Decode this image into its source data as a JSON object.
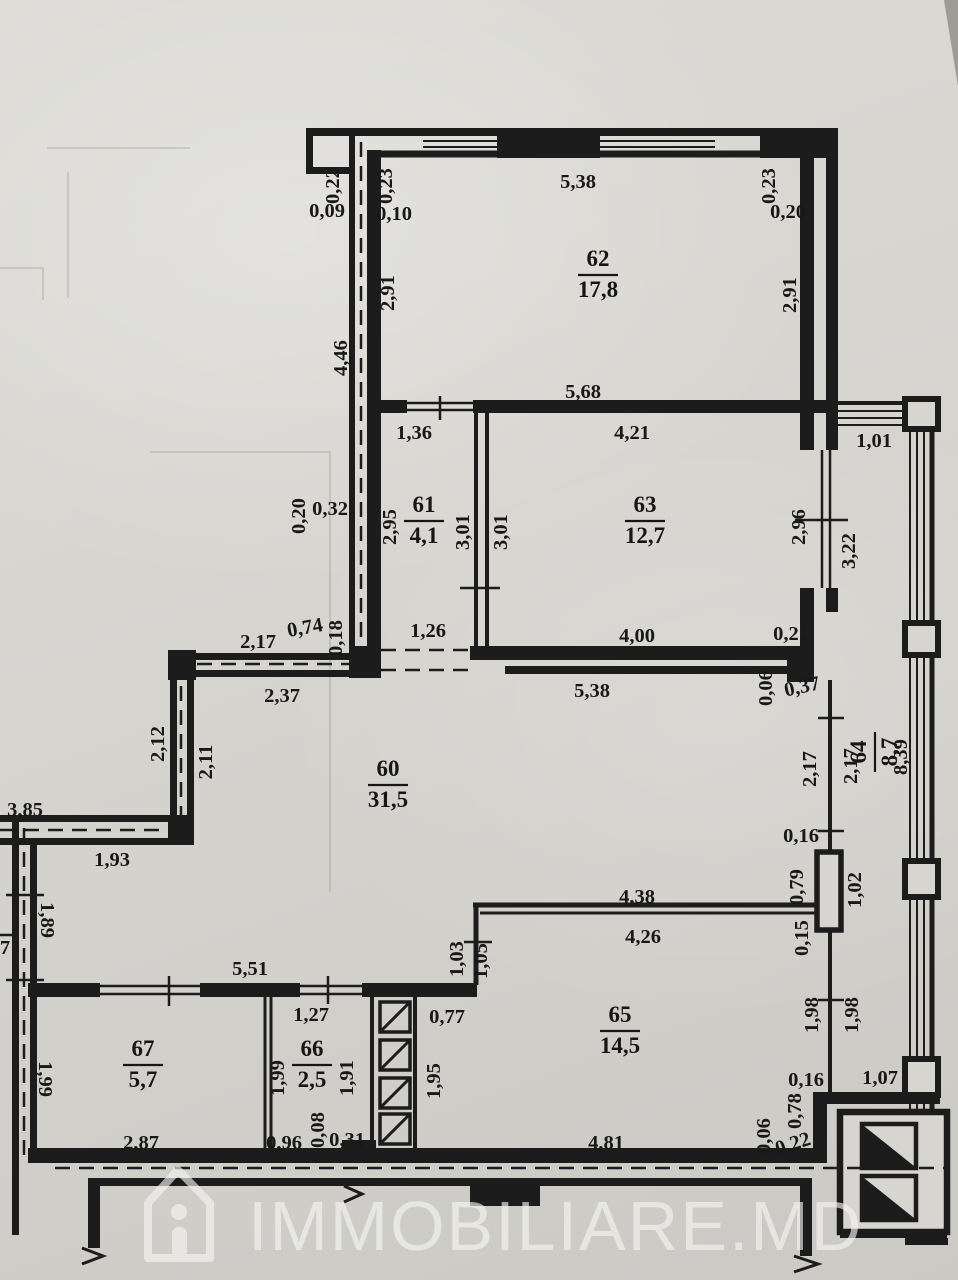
{
  "drawing": {
    "type": "apartment-floor-plan",
    "units": "meters",
    "paper_color": "#d6d4cf",
    "ink_color": "#1c1c1c"
  },
  "watermark": {
    "brand": "IMMOBILIARE.MD",
    "icon": "house-i-icon"
  },
  "rooms": [
    {
      "number": "62",
      "area": "17,8",
      "x": 598,
      "y": 272,
      "rot": 0
    },
    {
      "number": "61",
      "area": "4,1",
      "x": 424,
      "y": 518,
      "rot": 0
    },
    {
      "number": "63",
      "area": "12,7",
      "x": 645,
      "y": 518,
      "rot": 0
    },
    {
      "number": "60",
      "area": "31,5",
      "x": 388,
      "y": 782,
      "rot": 0
    },
    {
      "number": "64",
      "area": "8,7",
      "x": 872,
      "y": 752,
      "rot": -90
    },
    {
      "number": "67",
      "area": "5,7",
      "x": 143,
      "y": 1062,
      "rot": 0
    },
    {
      "number": "66",
      "area": "2,5",
      "x": 312,
      "y": 1062,
      "rot": 0
    },
    {
      "number": "65",
      "area": "14,5",
      "x": 620,
      "y": 1028,
      "rot": 0
    }
  ],
  "dims": [
    {
      "t": "0,22",
      "x": 333,
      "y": 186,
      "r": -90
    },
    {
      "t": "0,09",
      "x": 327,
      "y": 211,
      "r": 0
    },
    {
      "t": "0,23",
      "x": 386,
      "y": 186,
      "r": -90
    },
    {
      "t": "0,10",
      "x": 394,
      "y": 214,
      "r": 0
    },
    {
      "t": "5,38",
      "x": 578,
      "y": 182,
      "r": 0
    },
    {
      "t": "0,23",
      "x": 769,
      "y": 186,
      "r": -90
    },
    {
      "t": "0,20",
      "x": 788,
      "y": 212,
      "r": 0
    },
    {
      "t": "2,91",
      "x": 388,
      "y": 293,
      "r": -90
    },
    {
      "t": "2,91",
      "x": 790,
      "y": 295,
      "r": -90
    },
    {
      "t": "4,46",
      "x": 341,
      "y": 358,
      "r": -90
    },
    {
      "t": "5,68",
      "x": 583,
      "y": 392,
      "r": 0
    },
    {
      "t": "1,36",
      "x": 414,
      "y": 433,
      "r": 0
    },
    {
      "t": "4,21",
      "x": 632,
      "y": 433,
      "r": 0
    },
    {
      "t": "1,01",
      "x": 874,
      "y": 441,
      "r": 0
    },
    {
      "t": "0,20",
      "x": 299,
      "y": 516,
      "r": -90
    },
    {
      "t": "0,32",
      "x": 330,
      "y": 509,
      "r": 0
    },
    {
      "t": "2,95",
      "x": 390,
      "y": 527,
      "r": -90
    },
    {
      "t": "3,01",
      "x": 463,
      "y": 532,
      "r": -90
    },
    {
      "t": "3,01",
      "x": 501,
      "y": 532,
      "r": -90
    },
    {
      "t": "2,96",
      "x": 799,
      "y": 527,
      "r": -90
    },
    {
      "t": "3,22",
      "x": 849,
      "y": 551,
      "r": -90
    },
    {
      "t": "0,74",
      "x": 305,
      "y": 628,
      "r": -10
    },
    {
      "t": "0,18",
      "x": 336,
      "y": 638,
      "r": -90
    },
    {
      "t": "2,17",
      "x": 258,
      "y": 642,
      "r": 0
    },
    {
      "t": "1,26",
      "x": 428,
      "y": 631,
      "r": 0
    },
    {
      "t": "4,00",
      "x": 637,
      "y": 636,
      "r": 0
    },
    {
      "t": "0,21",
      "x": 791,
      "y": 634,
      "r": 0
    },
    {
      "t": "5,38",
      "x": 592,
      "y": 691,
      "r": 0
    },
    {
      "t": "2,37",
      "x": 282,
      "y": 696,
      "r": 0
    },
    {
      "t": "0,06",
      "x": 766,
      "y": 688,
      "r": -90
    },
    {
      "t": "0,37",
      "x": 802,
      "y": 687,
      "r": -12
    },
    {
      "t": "2,12",
      "x": 158,
      "y": 744,
      "r": -90
    },
    {
      "t": "2,11",
      "x": 206,
      "y": 762,
      "r": -90
    },
    {
      "t": "2,17",
      "x": 810,
      "y": 769,
      "r": -90
    },
    {
      "t": "2,17",
      "x": 851,
      "y": 766,
      "r": -90
    },
    {
      "t": "8,39",
      "x": 901,
      "y": 757,
      "r": -90
    },
    {
      "t": "3,85",
      "x": 25,
      "y": 810,
      "r": 0
    },
    {
      "t": "1,93",
      "x": 112,
      "y": 860,
      "r": 0
    },
    {
      "t": "0,16",
      "x": 801,
      "y": 836,
      "r": 0
    },
    {
      "t": "0,79",
      "x": 797,
      "y": 887,
      "r": -90
    },
    {
      "t": "1,02",
      "x": 855,
      "y": 890,
      "r": -90
    },
    {
      "t": "1,89",
      "x": 47,
      "y": 920,
      "r": 90
    },
    {
      "t": "7",
      "x": 5,
      "y": 948,
      "r": 0
    },
    {
      "t": "0,15",
      "x": 802,
      "y": 938,
      "r": -90
    },
    {
      "t": "4,38",
      "x": 637,
      "y": 897,
      "r": 0
    },
    {
      "t": "4,26",
      "x": 643,
      "y": 937,
      "r": 0
    },
    {
      "t": "1,03",
      "x": 457,
      "y": 959,
      "r": -90
    },
    {
      "t": "1,05",
      "x": 481,
      "y": 961,
      "r": -90
    },
    {
      "t": "5,51",
      "x": 250,
      "y": 969,
      "r": 0
    },
    {
      "t": "1,98",
      "x": 812,
      "y": 1015,
      "r": -90
    },
    {
      "t": "1,98",
      "x": 852,
      "y": 1015,
      "r": -90
    },
    {
      "t": "1,27",
      "x": 311,
      "y": 1015,
      "r": 0
    },
    {
      "t": "0,77",
      "x": 447,
      "y": 1017,
      "r": 0
    },
    {
      "t": "1,99",
      "x": 45,
      "y": 1079,
      "r": 90
    },
    {
      "t": "1,99",
      "x": 278,
      "y": 1078,
      "r": -90
    },
    {
      "t": "1,91",
      "x": 347,
      "y": 1078,
      "r": -90
    },
    {
      "t": "1,95",
      "x": 434,
      "y": 1081,
      "r": -90
    },
    {
      "t": "0,16",
      "x": 806,
      "y": 1080,
      "r": 0
    },
    {
      "t": "1,07",
      "x": 880,
      "y": 1078,
      "r": 0
    },
    {
      "t": "0,78",
      "x": 795,
      "y": 1111,
      "r": -90
    },
    {
      "t": "0,96",
      "x": 284,
      "y": 1143,
      "r": 0
    },
    {
      "t": "0,08",
      "x": 318,
      "y": 1130,
      "r": -90
    },
    {
      "t": "0,31",
      "x": 347,
      "y": 1140,
      "r": 0
    },
    {
      "t": "2,87",
      "x": 141,
      "y": 1143,
      "r": 0
    },
    {
      "t": "4,81",
      "x": 606,
      "y": 1143,
      "r": 0
    },
    {
      "t": "0,06",
      "x": 764,
      "y": 1136,
      "r": -90
    },
    {
      "t": "0,22",
      "x": 793,
      "y": 1144,
      "r": -18
    }
  ]
}
